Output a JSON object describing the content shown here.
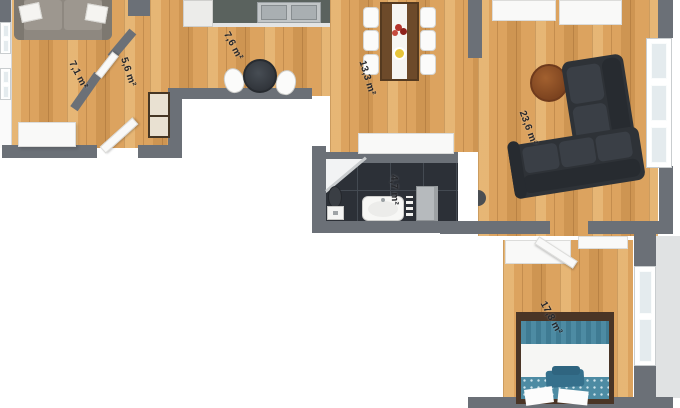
{
  "plan": {
    "area_unit": "m²",
    "rooms": [
      {
        "id": "lounge",
        "area_label": "7,1 m²"
      },
      {
        "id": "hall",
        "area_label": "5,6 m²"
      },
      {
        "id": "kitchen",
        "area_label": "7,6 m²"
      },
      {
        "id": "dining",
        "area_label": "13,3 m²"
      },
      {
        "id": "bathroom",
        "area_label": "4,7 m²"
      },
      {
        "id": "living_room",
        "area_label": "23,6 m²"
      },
      {
        "id": "bedroom",
        "area_label": "17,8 m²"
      }
    ],
    "furniture_visible": [
      "sofa",
      "pillows",
      "desk",
      "hall-cabinet",
      "entrance-door",
      "interior-door",
      "kitchen-cabinet",
      "kitchen-counter",
      "double-sink",
      "bistro-table",
      "bistro-chairs",
      "dining-table",
      "dining-chairs",
      "flowers",
      "plate",
      "sideboard",
      "corner-shower",
      "toilet",
      "washbasin",
      "bathroom-cabinet",
      "sectional-sofa",
      "coffee-table",
      "windows",
      "wardrobe",
      "bedroom-door",
      "shelf",
      "double-bed",
      "bed-pillows",
      "bed-blanket"
    ],
    "colors": {
      "wall": "#6b7077",
      "wood_floor": "#dca35f",
      "bathroom_tile": "#2c3037",
      "sofa_gray": "#908a82",
      "sectional_dark": "#2e3237",
      "bed_accent_blue": "#4d8ba3",
      "table_brown": "#6d4a2a",
      "coffee_table_brown": "#8a4e28",
      "label_text": "#26272b"
    }
  }
}
